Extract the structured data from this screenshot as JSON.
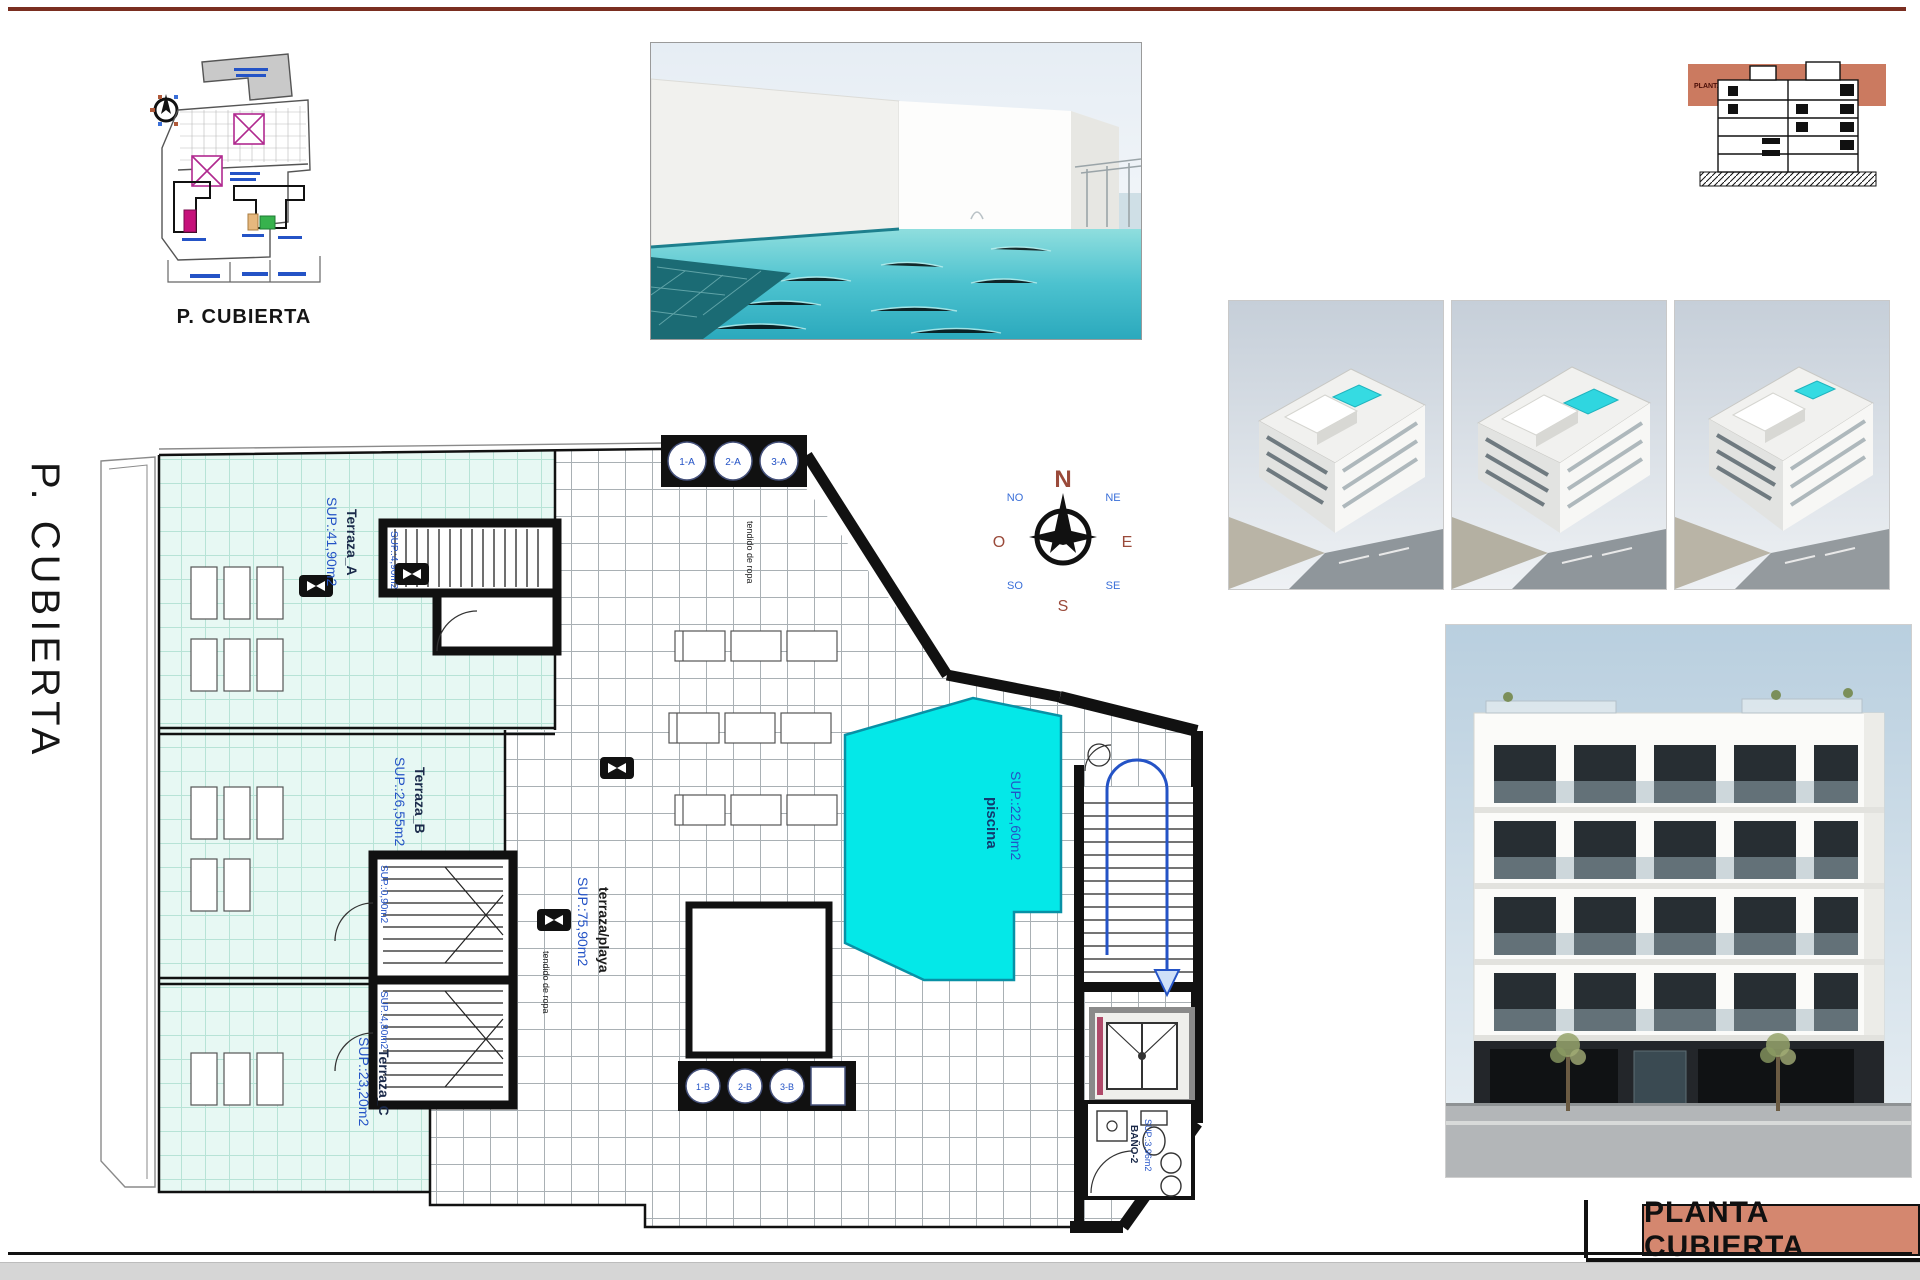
{
  "page": {
    "top_rule_color": "#7a2e20",
    "bottom_band_color": "#d6d6d6",
    "background": "#ffffff"
  },
  "side_title": "P. CUBIERTA",
  "site_plan": {
    "caption": "P. CUBIERTA"
  },
  "section_drawing": {
    "band_label": "PLANTA CUBIERTA"
  },
  "compass": {
    "n": "N",
    "e": "E",
    "s": "S",
    "w": "O",
    "ne": "NE",
    "nw": "NO",
    "se": "SE",
    "sw": "SO"
  },
  "floor_plan": {
    "rooms": [
      {
        "name": "Terraza_A",
        "area": "SUP.:41,90m2"
      },
      {
        "name": "Terraza_B",
        "area": "SUP.:26,55m2"
      },
      {
        "name": "Terraza_C",
        "area": "SUP.:23,20m2"
      },
      {
        "name": "terraza/playa",
        "area": "SUP.:75,90m2"
      },
      {
        "name": "piscina",
        "area": "SUP.:22,60m2"
      },
      {
        "name": "BAÑO-2",
        "area": "SUP.:3,96m2"
      }
    ],
    "stair_labels": [
      "SUP.:4,90m2",
      "SUP.:0,90m2",
      "SUP.:4,80m2"
    ],
    "skylights_top": [
      "1-A",
      "2-A",
      "3-A"
    ],
    "skylights_bottom": [
      "1-B",
      "2-B",
      "3-B"
    ],
    "clothesline_label": "tendido de ropa",
    "colors": {
      "pool": "#04e8e8",
      "terrace_tile": "#e7f8f3",
      "label_blue": "#2453c6",
      "wall_black": "#111111",
      "title_salmon": "#d4876f"
    }
  },
  "title_block": {
    "label": "PLANTA CUBIERTA"
  }
}
